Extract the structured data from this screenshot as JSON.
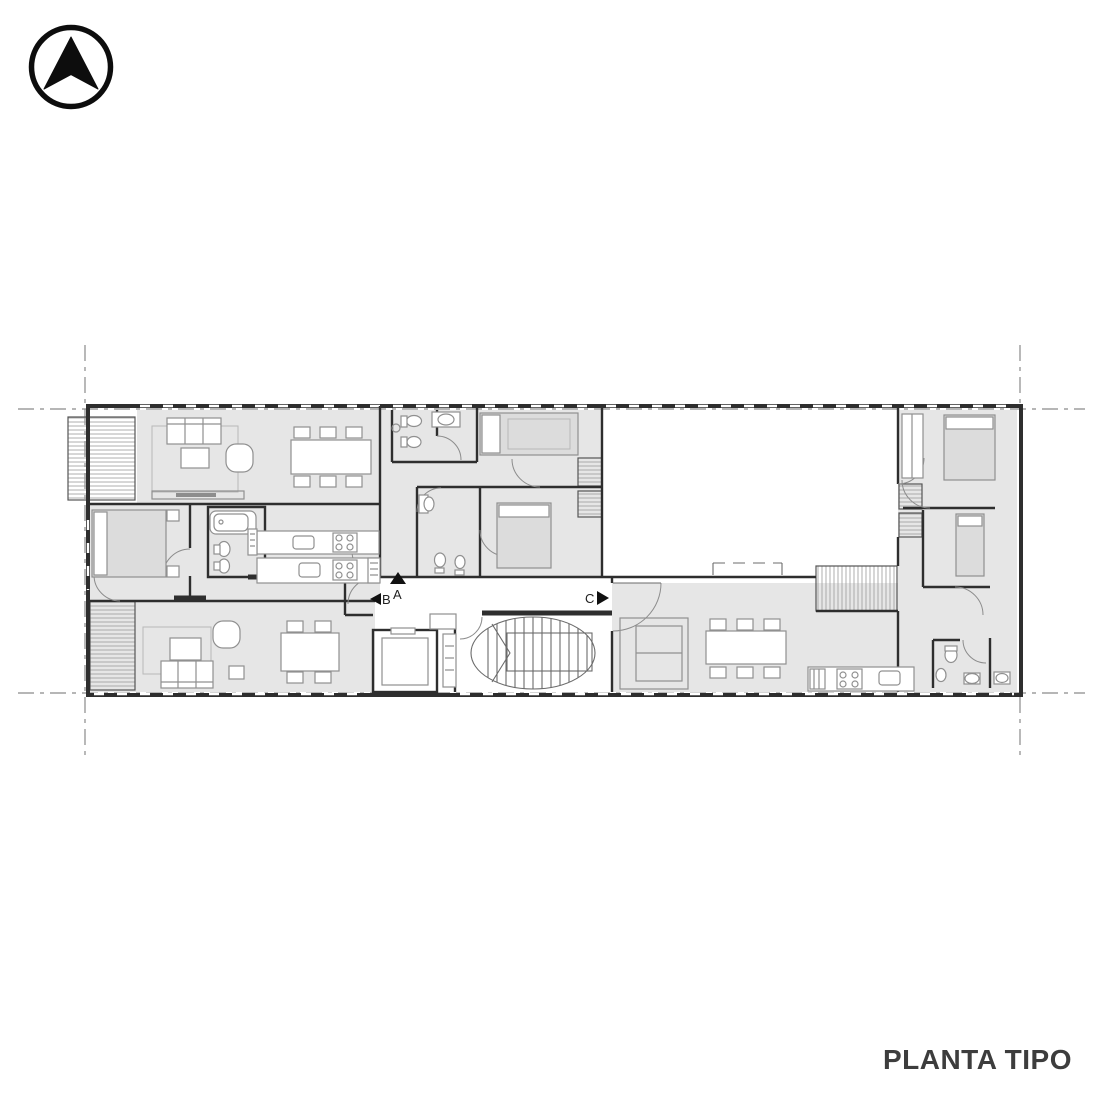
{
  "title": {
    "label": "PLANTA TIPO"
  },
  "north_arrow": {
    "icon": "north-arrow-icon",
    "points": "up"
  },
  "section_markers": {
    "a": {
      "label": "A",
      "direction": "up"
    },
    "b": {
      "label": "B",
      "direction": "left"
    },
    "c": {
      "label": "C",
      "direction": "right"
    }
  },
  "colors": {
    "background": "#ffffff",
    "wall": "#2e2e2e",
    "room-fill": "#e6e6e6",
    "bed-fill": "#dcdcdc",
    "furniture-line": "#909090",
    "refline": "#8a8a8a",
    "text": "#3d3d3d"
  }
}
